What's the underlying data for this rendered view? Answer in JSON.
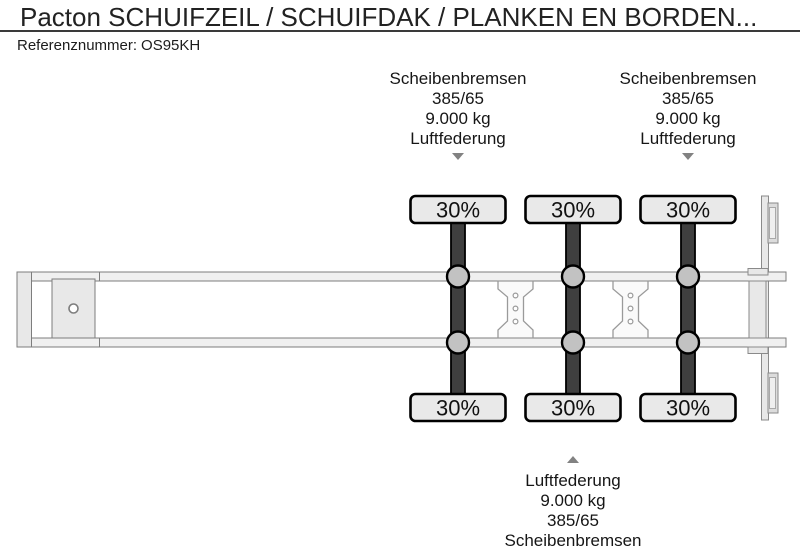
{
  "header": {
    "title": "Pacton SCHUIFZEIL / SCHUIFDAK / PLANKEN EN BORDEN...",
    "reference_label": "Referenznummer:",
    "reference_value": "OS95KH"
  },
  "diagram": {
    "type": "trailer-axle-configuration-top-view",
    "axle_count": 3,
    "axle_loads": [
      {
        "top": "30%",
        "bottom": "30%"
      },
      {
        "top": "30%",
        "bottom": "30%"
      },
      {
        "top": "30%",
        "bottom": "30%"
      }
    ],
    "callouts": [
      {
        "position": "top",
        "axle": 1,
        "lines": [
          "Scheibenbremsen",
          "385/65",
          "9.000 kg",
          "Luftfederung"
        ]
      },
      {
        "position": "top",
        "axle": 3,
        "lines": [
          "Scheibenbremsen",
          "385/65",
          "9.000 kg",
          "Luftfederung"
        ]
      },
      {
        "position": "bottom",
        "axle": 2,
        "lines": [
          "Luftfederung",
          "9.000 kg",
          "385/65",
          "Scheibenbremsen"
        ]
      }
    ],
    "colors": {
      "axle_bar": "#3f3f3f",
      "hub_fill": "#c2c2c2",
      "tire_box_fill": "#e9e9e9",
      "rail_fill": "#f0f0f0",
      "frame_fill": "#e8e8e8",
      "rear_light_fill": "#dcdcdc",
      "callout_arrow": "#828282"
    }
  }
}
